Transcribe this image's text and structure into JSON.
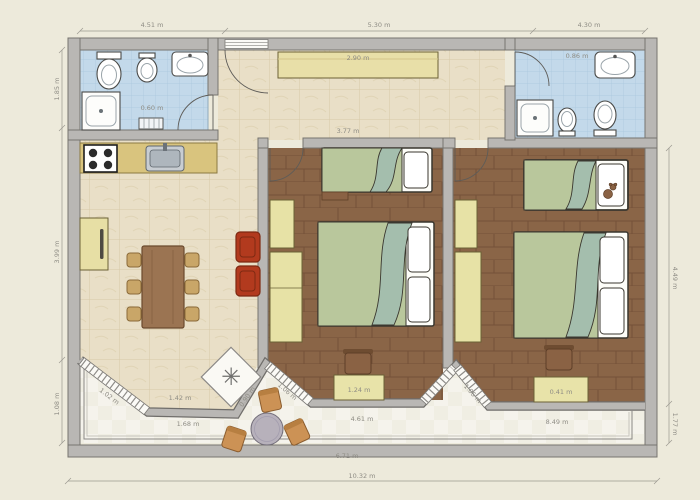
{
  "plan": {
    "kind": "apartment-floor-plan"
  },
  "icons": {
    "fan_glyph": "✳"
  },
  "colors": {
    "background": "#edeadb",
    "wall_fill": "#b9b7b4",
    "wall_edge": "#76746f",
    "tile_floor": "#e9dfc7",
    "bathroom_floor": "#c3d9ea",
    "wood_floor": "#8a6547",
    "terrace_floor": "#f5f3ec",
    "furniture_beige": "#e7dfa5",
    "bed_green": "#b9c79c",
    "bed_fold_green": "#a4bead",
    "armchair_red": "#b23a1e",
    "dining_table_brown": "#9b7452",
    "dining_chair_tan": "#c9a668",
    "terrace_chair_tan": "#cc9255",
    "kitchen_counter": "#d9c47e",
    "round_table_gray": "#b7b1bb"
  },
  "dimensions": {
    "top": [
      {
        "text": "4.51 m"
      },
      {
        "text": "5.30 m"
      },
      {
        "text": "4.30 m"
      }
    ],
    "left": [
      {
        "text": "1.85 m"
      },
      {
        "text": "3.99 m"
      },
      {
        "text": "1.08 m"
      }
    ],
    "right": [
      {
        "text": "4.49 m"
      },
      {
        "text": "1.77 m"
      }
    ],
    "bottom": [
      {
        "text": "10.32 m"
      }
    ],
    "interior": [
      {
        "text": "2.90 m"
      },
      {
        "text": "3.77 m"
      },
      {
        "text": "0.86 m"
      },
      {
        "text": "0.60 m"
      },
      {
        "text": "1.42 m"
      },
      {
        "text": "1.68 m"
      },
      {
        "text": "1.02 m"
      },
      {
        "text": "0.90 m"
      },
      {
        "text": "1.06 m"
      },
      {
        "text": "1.06 m"
      },
      {
        "text": "4.61 m"
      },
      {
        "text": "1.24 m"
      },
      {
        "text": "8.49 m"
      },
      {
        "text": "6.71 m"
      },
      {
        "text": "0.41 m"
      }
    ]
  }
}
